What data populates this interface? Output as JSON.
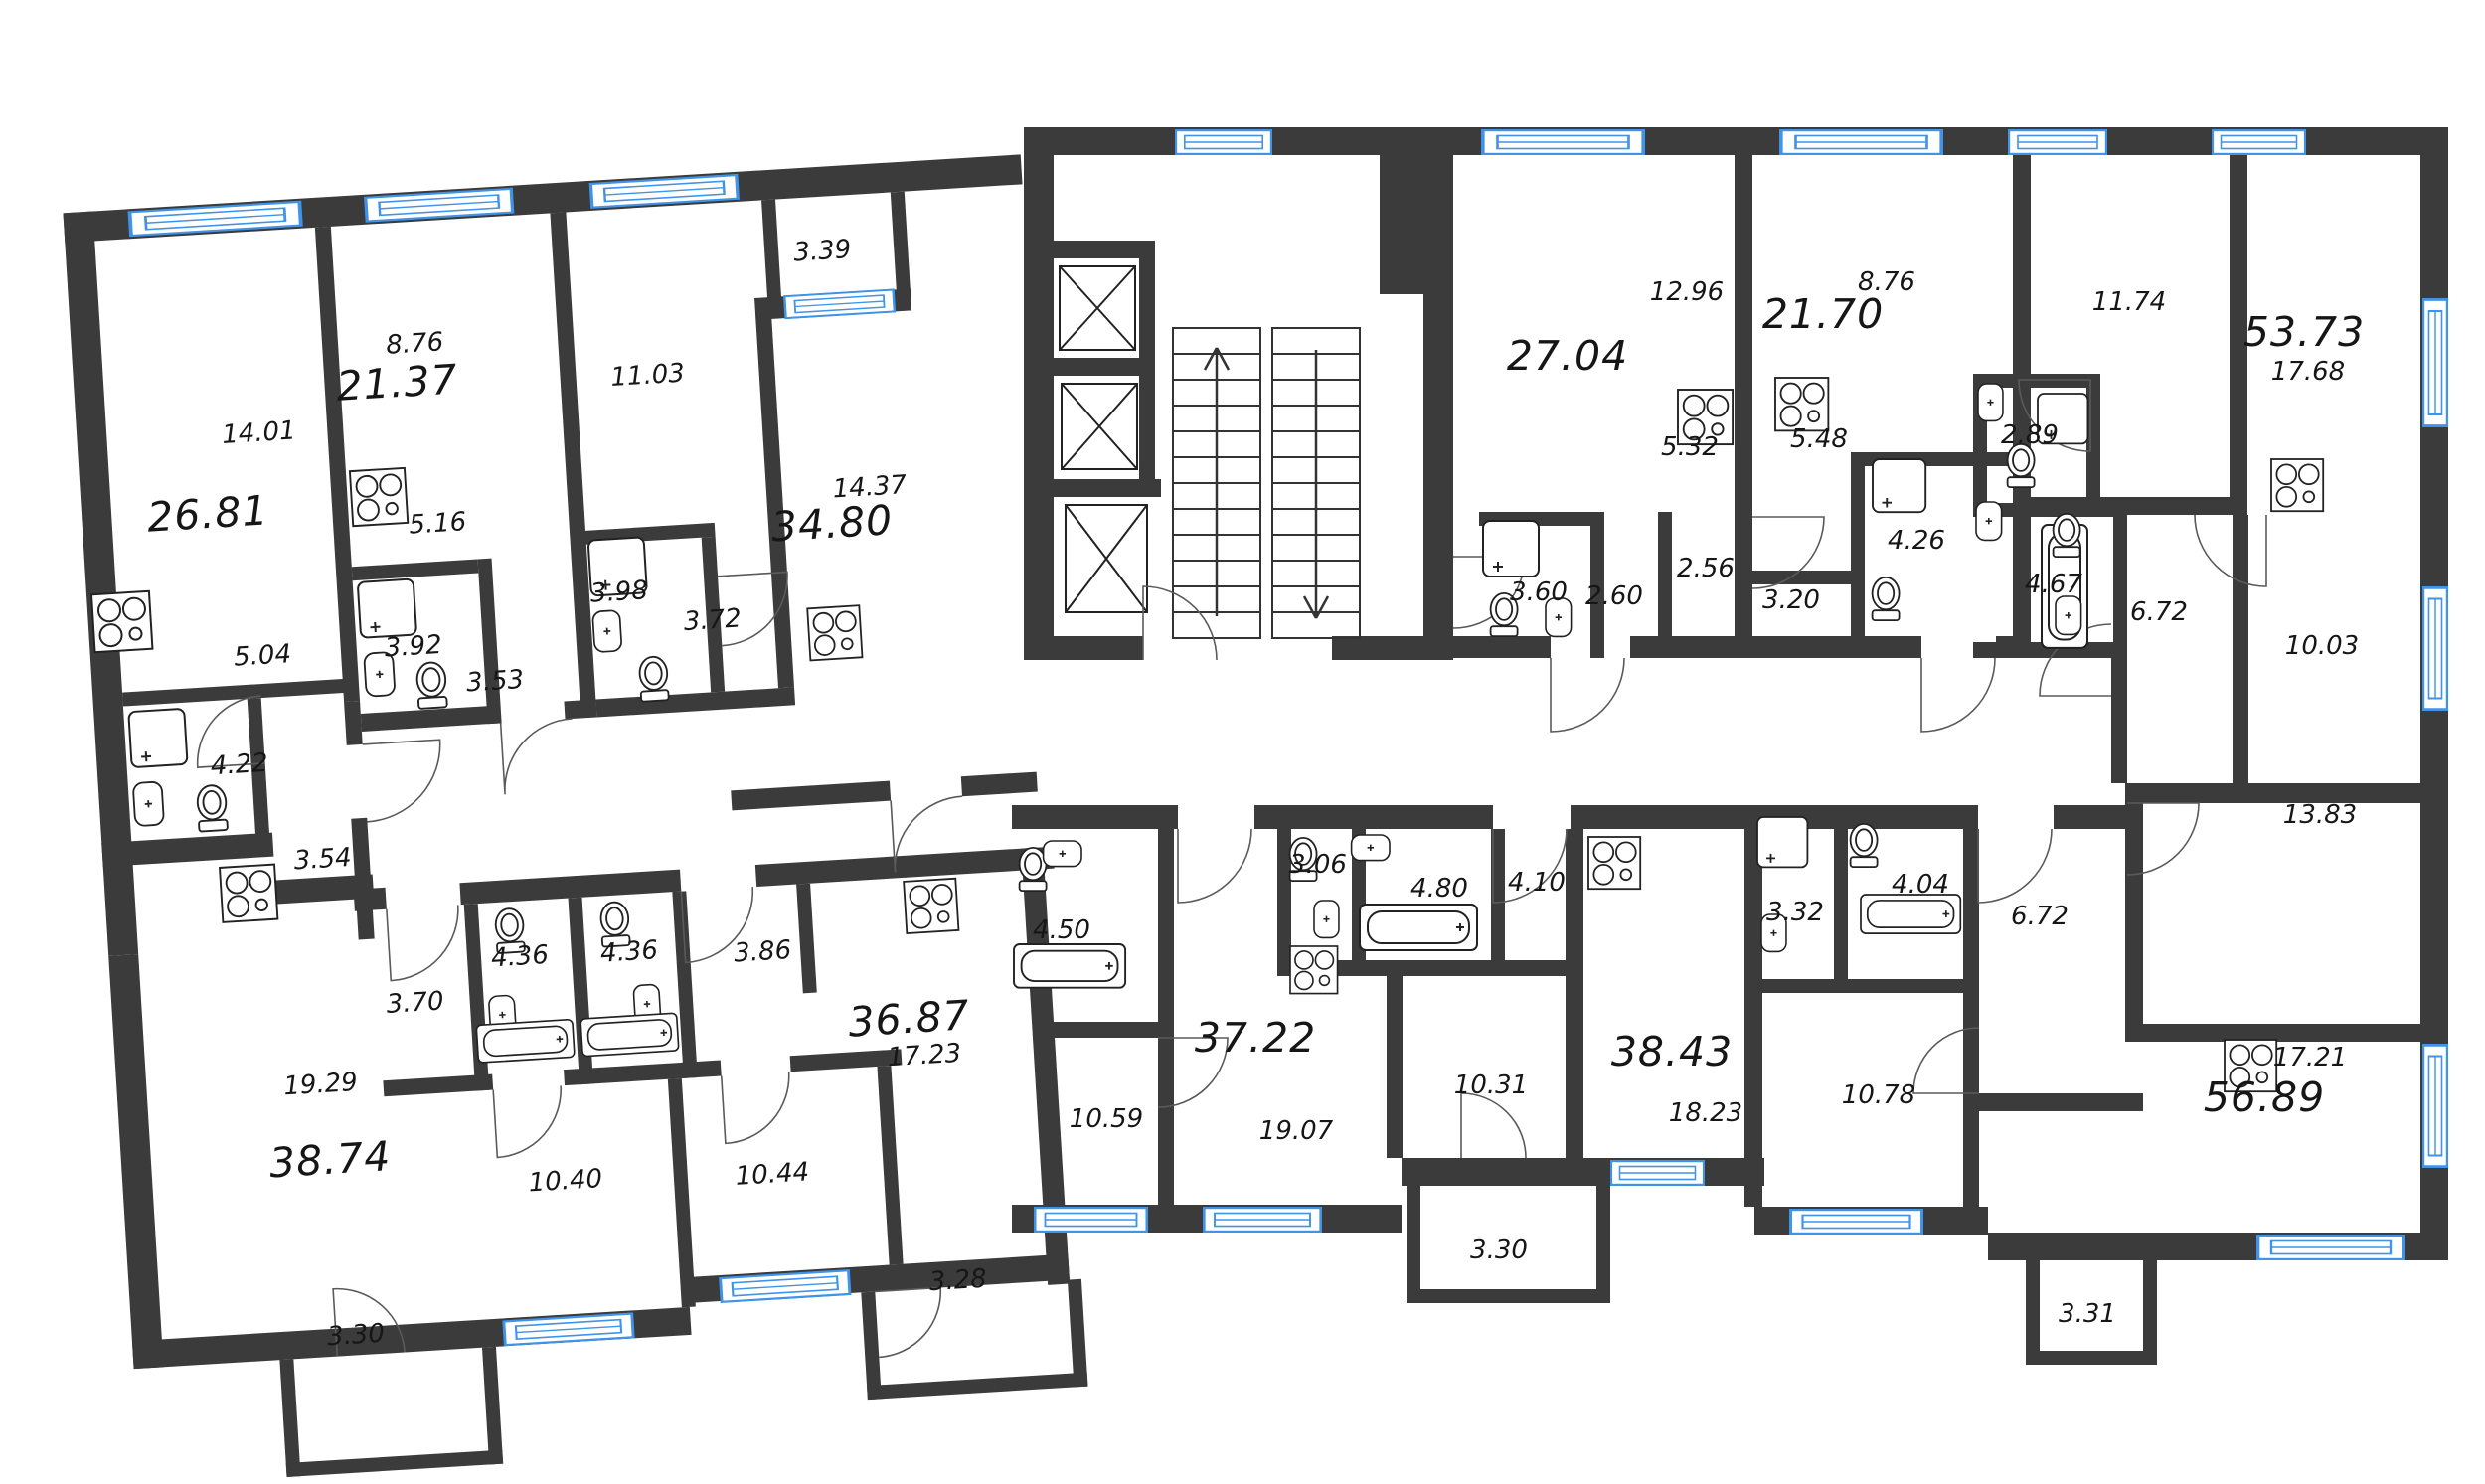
{
  "plan_type": "residential-floor-plan",
  "colors": {
    "wall": "#3b3b3b",
    "window_frame": "#3f93e8",
    "fixture_line": "#222222",
    "text": "#161616"
  },
  "apartments": [
    {
      "total": "26.81",
      "rooms": [
        "14.01",
        "5.04",
        "4.22",
        "3.54"
      ]
    },
    {
      "total": "21.37",
      "rooms": [
        "8.76",
        "5.16",
        "3.92",
        "3.53"
      ]
    },
    {
      "total": "34.80",
      "rooms": [
        "14.37",
        "11.03",
        "3.98",
        "3.72"
      ],
      "loggia": "3.39"
    },
    {
      "total": "27.04",
      "rooms": [
        "12.96",
        "5.32",
        "3.60",
        "2.60",
        "2.56"
      ]
    },
    {
      "total": "21.70",
      "rooms": [
        "8.76",
        "5.48",
        "4.26",
        "3.20"
      ]
    },
    {
      "total": "53.73",
      "rooms": [
        "17.68",
        "11.74",
        "10.03",
        "6.72",
        "4.67",
        "2.89"
      ]
    },
    {
      "total": "38.74",
      "rooms": [
        "19.29",
        "10.40",
        "4.36",
        "3.70"
      ],
      "balcony": "3.30"
    },
    {
      "total": "36.87",
      "rooms": [
        "17.23",
        "10.44",
        "4.36",
        "3.86"
      ],
      "balcony": "3.28"
    },
    {
      "total": "37.22",
      "rooms": [
        "19.07",
        "10.59",
        "4.50",
        "3.06"
      ]
    },
    {
      "total": "38.43",
      "rooms": [
        "18.23",
        "10.31",
        "4.80",
        "4.10"
      ],
      "balcony": "3.30"
    },
    {
      "total": "56.89",
      "rooms": [
        "17.21",
        "13.83",
        "10.78",
        "6.72",
        "4.04",
        "3.32"
      ],
      "balcony": "3.31"
    }
  ]
}
